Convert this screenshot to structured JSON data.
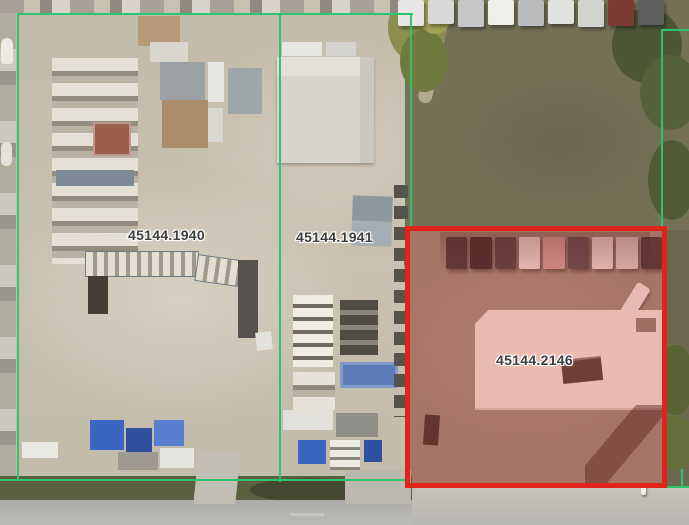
{
  "map": {
    "view_type": "aerial-parcel-map",
    "parcels": [
      {
        "id": "45144.1940",
        "highlighted": false
      },
      {
        "id": "45144.1941",
        "highlighted": false
      },
      {
        "id": "45144.2146",
        "highlighted": true
      }
    ],
    "colors": {
      "parcel_line": "#2EC46F",
      "highlight_border": "#E0241A",
      "highlight_fill": "rgba(222,45,30,0.26)",
      "label_text": "#3E3E3E",
      "label_halo": "#FFFFFF"
    }
  }
}
